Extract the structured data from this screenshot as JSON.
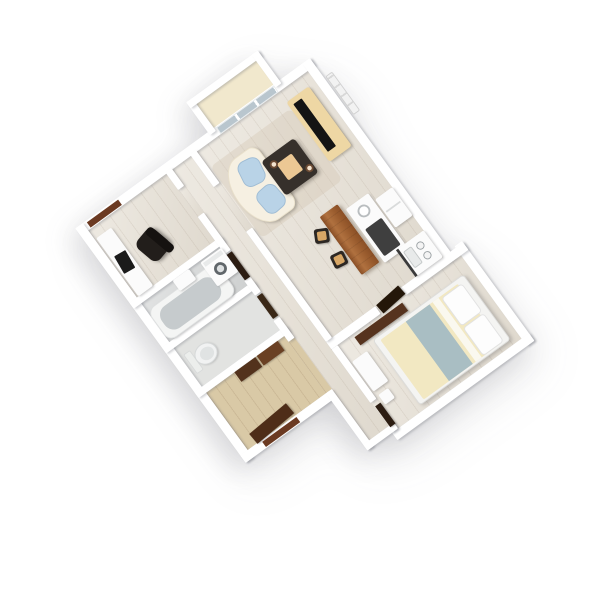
{
  "scene": {
    "type": "3d-floorplan-render",
    "description": "Top-down 3D rendering of a one-bedroom apartment floor plan, rotated diagonally on a white background",
    "rotation_deg": -36,
    "background": "#ffffff"
  },
  "colors": {
    "wall": "#ffffff",
    "floor_wood": "#e6e0d5",
    "floor_bath": "#d7d9d9",
    "floor_wc": "#e2e3e1",
    "floor_entry": "#d9c9a6",
    "floor_balcony": "#f1e8cd",
    "white_furniture": "#fbfbfb",
    "rug": "#e3d9c8",
    "sofa": "#f6f0e2",
    "cushion_blue": "#b9d3e7",
    "table_espresso": "#36302b",
    "tray_tan": "#ecc894",
    "tv_stand_tan": "#eed7a4",
    "tv_black": "#141414",
    "bar_wood": "#a96a3c",
    "stool_dark": "#2c2723",
    "stool_seat": "#d8a766",
    "island_top_dark": "#3f3f3f",
    "fixture_gray": "#c6cbcd",
    "washer_ring": "#60666a",
    "dark_brown": "#56331e",
    "door_brown": "#6b3a22",
    "duvet_cream": "#f2e8c2",
    "runner_bluegray": "#a9bec3",
    "pillow_white": "#fdfdfd",
    "glass": "#b9c6ce",
    "chair_black": "#221e1b"
  },
  "rooms": [
    {
      "id": "living-room",
      "label": "Living room",
      "floor": "wood",
      "furniture": [
        {
          "id": "sofa",
          "label": "Curved cream sofa"
        },
        {
          "id": "sofa-cushion",
          "label": "Blue seat cushion"
        },
        {
          "id": "coffee-table",
          "label": "Espresso coffee table"
        },
        {
          "id": "tray",
          "label": "Tan serving tray"
        },
        {
          "id": "cup",
          "label": "Cup"
        },
        {
          "id": "rug",
          "label": "Beige rug"
        },
        {
          "id": "tv-stand",
          "label": "Light oak TV stand"
        },
        {
          "id": "tv",
          "label": "Flat-screen TV"
        },
        {
          "id": "radiator",
          "label": "Radiator"
        },
        {
          "id": "glass-door",
          "label": "Sliding glass balcony door"
        }
      ]
    },
    {
      "id": "balcony",
      "label": "Balcony",
      "floor": "cream",
      "furniture": []
    },
    {
      "id": "kitchen",
      "label": "Open kitchen",
      "floor": "wood",
      "furniture": [
        {
          "id": "breakfast-bar",
          "label": "Wooden breakfast bar"
        },
        {
          "id": "bar-stool-1",
          "label": "Bar stool"
        },
        {
          "id": "bar-stool-2",
          "label": "Bar stool"
        },
        {
          "id": "island",
          "label": "White island unit with dark top"
        },
        {
          "id": "fridge",
          "label": "Fridge"
        },
        {
          "id": "sink-counter",
          "label": "Sink counter"
        },
        {
          "id": "tap",
          "label": "Tap"
        }
      ]
    },
    {
      "id": "bedroom",
      "label": "Bedroom",
      "floor": "wood",
      "furniture": [
        {
          "id": "double-bed",
          "label": "Double bed with cream duvet"
        },
        {
          "id": "bed-runner",
          "label": "Blue-gray bed runner"
        },
        {
          "id": "pillow-1",
          "label": "Pillow"
        },
        {
          "id": "pillow-2",
          "label": "Pillow"
        },
        {
          "id": "headboard-shelf",
          "label": "Dark walnut headboard shelf"
        },
        {
          "id": "dresser",
          "label": "White dresser"
        },
        {
          "id": "bed-stool",
          "label": "White stool"
        }
      ]
    },
    {
      "id": "bathroom",
      "label": "Bathroom",
      "floor": "gray-tile",
      "furniture": [
        {
          "id": "bathtub",
          "label": "Bathtub"
        },
        {
          "id": "washing-machine",
          "label": "Washing machine"
        },
        {
          "id": "vanity",
          "label": "Vanity cabinet"
        }
      ]
    },
    {
      "id": "wc",
      "label": "WC",
      "floor": "gray-tile",
      "furniture": [
        {
          "id": "toilet",
          "label": "Toilet"
        }
      ]
    },
    {
      "id": "office",
      "label": "Office / study",
      "floor": "wood",
      "furniture": [
        {
          "id": "desk",
          "label": "White desk"
        },
        {
          "id": "laptop",
          "label": "Black laptop"
        },
        {
          "id": "office-chair",
          "label": "Black office chair"
        }
      ]
    },
    {
      "id": "hallway",
      "label": "Hallway",
      "floor": "wood",
      "furniture": []
    },
    {
      "id": "entry",
      "label": "Entry hall",
      "floor": "tan-wood",
      "furniture": [
        {
          "id": "closet",
          "label": "Dark brown closet sliding doors"
        },
        {
          "id": "entry-door",
          "label": "Entry door"
        },
        {
          "id": "entry-door-leaf",
          "label": "Open door leaf"
        }
      ]
    }
  ]
}
